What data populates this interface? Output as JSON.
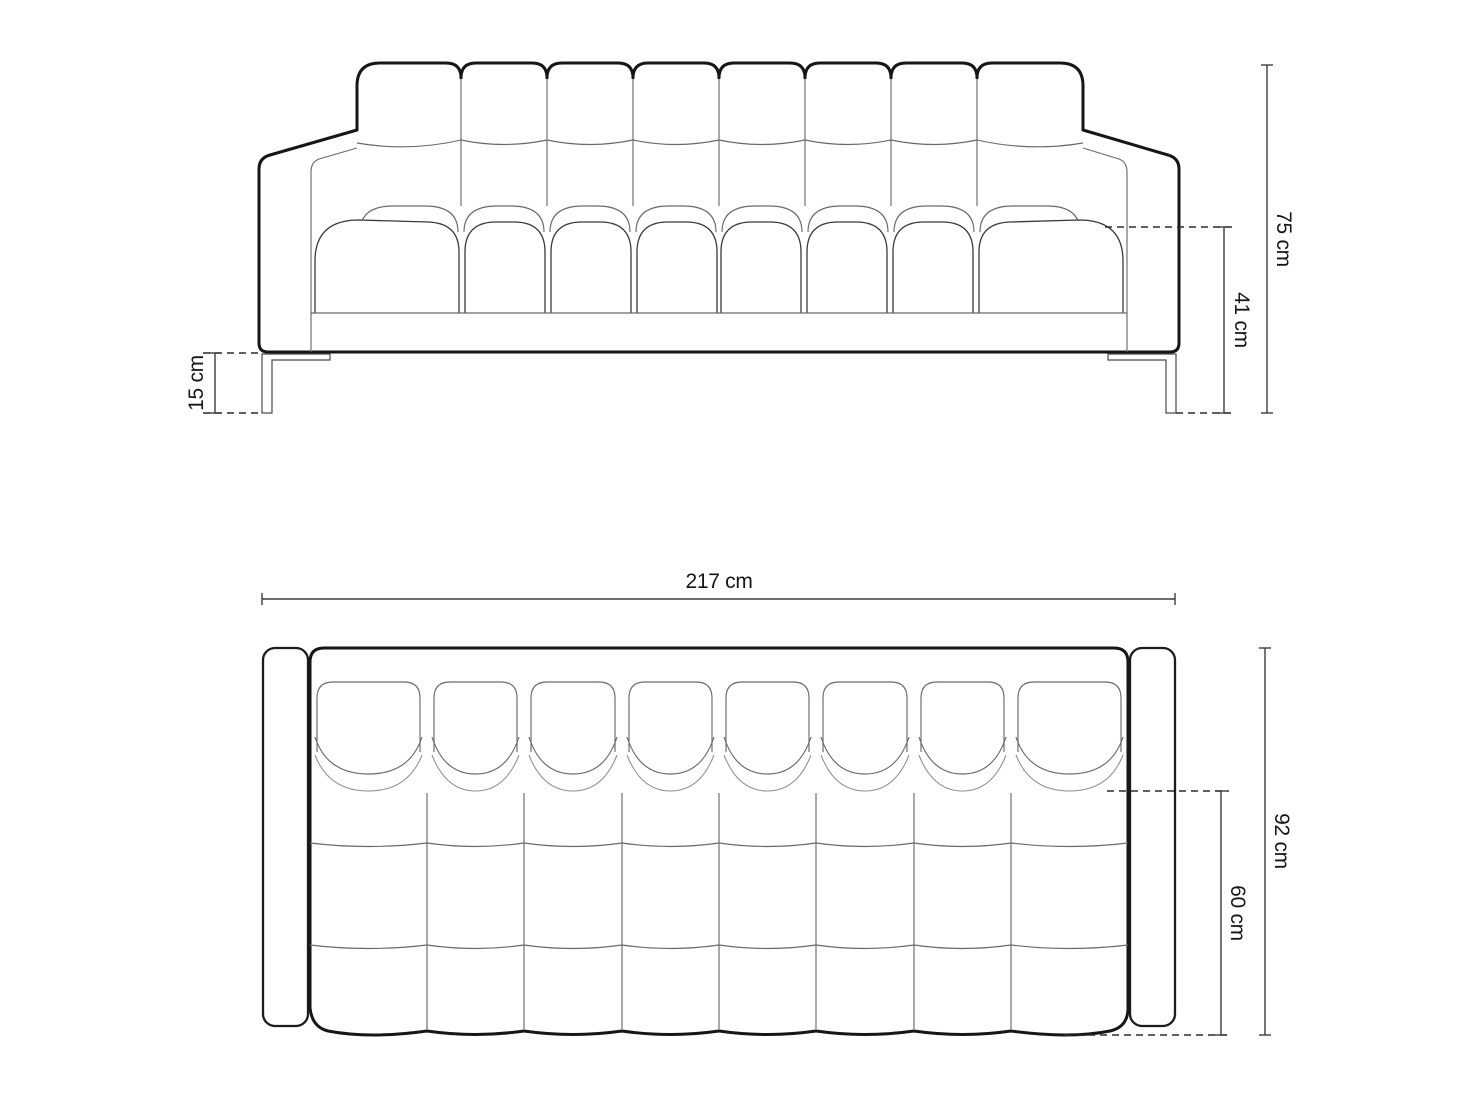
{
  "drawing": {
    "subject": "sofa-technical-drawing",
    "front_view": {
      "height": "75 cm",
      "seat_height": "41 cm",
      "leg_height": "15 cm"
    },
    "top_view": {
      "width": "217 cm",
      "depth": "92 cm",
      "seat_depth": "60 cm"
    },
    "colors": {
      "background": "#ffffff",
      "outline": "#161616",
      "seam": "#6a6a6a",
      "dimension": "#3d3d3d"
    }
  }
}
